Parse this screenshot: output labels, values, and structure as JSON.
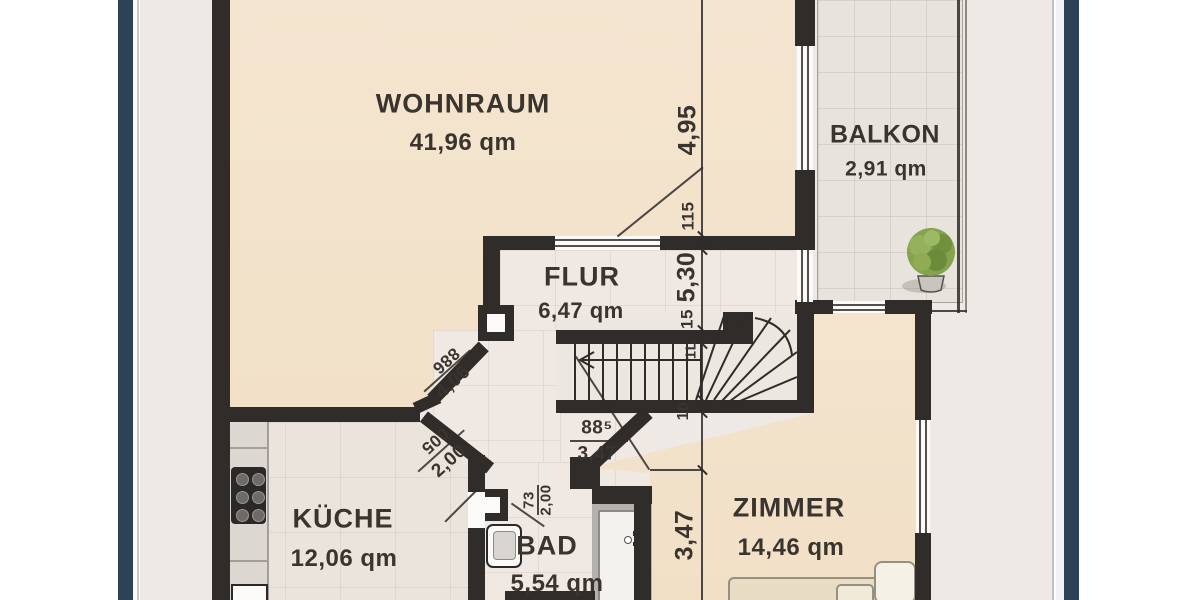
{
  "plan": {
    "type": "floorplan",
    "language": "de",
    "rooms": [
      {
        "key": "wohnraum",
        "name": "WOHNRAUM",
        "area": "41,96 qm"
      },
      {
        "key": "balkon",
        "name": "BALKON",
        "area": "2,91 qm"
      },
      {
        "key": "flur",
        "name": "FLUR",
        "area": "6,47 qm"
      },
      {
        "key": "kueche",
        "name": "KÜCHE",
        "area": "12,06 qm"
      },
      {
        "key": "bad",
        "name": "BAD",
        "area": "5,54 qm"
      },
      {
        "key": "zimmer",
        "name": "ZIMMER",
        "area": "14,46 qm"
      }
    ],
    "dims": {
      "right_chain": [
        "4,95",
        "115",
        "5,30",
        "15",
        "1L",
        "10",
        "3,47"
      ],
      "diag_upper": {
        "top": "886",
        "bottom": "4,06"
      },
      "diag_lower": {
        "top": "005",
        "bottom": "2,00"
      },
      "door_fraction": {
        "top": "88⁵",
        "bottom": "3,47"
      },
      "bad_door": {
        "top": "73",
        "bottom": "2,00"
      }
    },
    "colors": {
      "frame_navy": "#2e4257",
      "wall": "#2f2c29",
      "room_beige": "#f3e3cc",
      "tile_light": "#efe8e2",
      "balcony_tile": "#e8e4dd",
      "plan_bg": "#efe9e5",
      "text": "#3a342e"
    },
    "icons": [
      "plant-icon",
      "stove-icon",
      "sink-icon",
      "washbasin-icon",
      "door-icon",
      "bed-icon",
      "stairs-icon"
    ]
  }
}
